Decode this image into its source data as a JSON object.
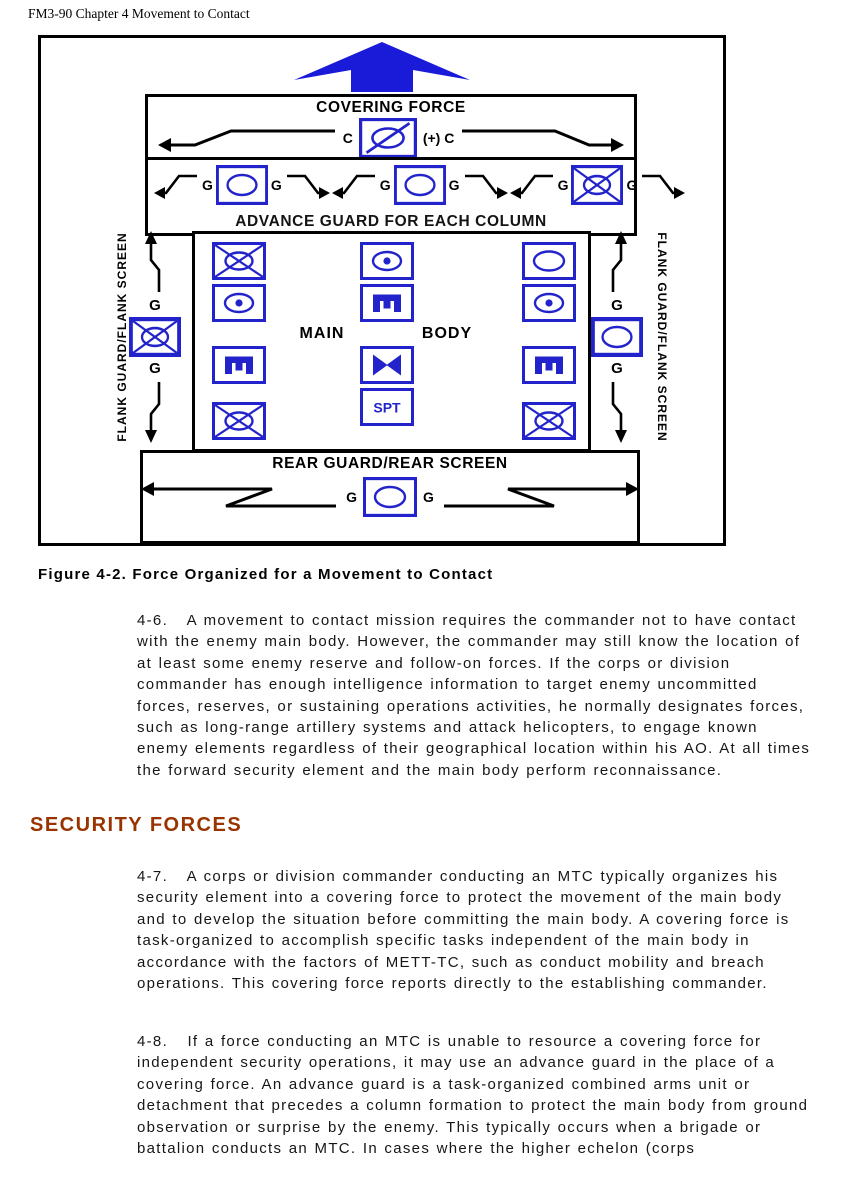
{
  "document": {
    "header": "FM3-90 Chapter 4 Movement to Contact",
    "figure_caption": "Figure 4-2. Force Organized for a Movement to Contact",
    "section_heading": "SECURITY FORCES",
    "paragraphs": [
      {
        "id": "4-6",
        "text": "4-6.   A movement to contact mission requires the commander not to have contact with the enemy main body. However, the commander may still know the location of at least some enemy reserve and follow-on forces. If the corps or division commander has enough intelligence information to target enemy uncommitted forces, reserves, or sustaining operations activities, he normally designates forces, such as long-range artillery systems and attack helicopters, to engage known enemy elements regardless of their geographical location within his AO. At all times the forward security element and the main body perform reconnaissance."
      },
      {
        "id": "4-7",
        "text": "4-7.   A corps or division commander conducting an MTC typically organizes his security element into a covering force to protect the movement of the main body and to develop the situation before committing the main body. A covering force is task-organized to accomplish specific tasks independent of the main body in accordance with the factors of METT-TC, such as conduct mobility and breach operations. This covering force reports directly to the establishing commander."
      },
      {
        "id": "4-8",
        "text": "4-8.   If a force conducting an MTC is unable to resource a covering force for independent security operations, it may use an advance guard in the place of a covering force. An advance guard is a task-organized combined arms unit or detachment that precedes a column formation to protect the main body from ground observation or surprise by the enemy. This typically occurs when a brigade or battalion conducts an MTC. In cases where the higher echelon (corps"
      }
    ]
  },
  "figure": {
    "colors": {
      "symbol_blue": "#2323cc",
      "direction_arrow_blue": "#1a1ad9",
      "heading_brown": "#993300"
    },
    "covering_force": {
      "title": "COVERING FORCE",
      "left_label": "C",
      "right_label": "(+) C",
      "symbol": "cavalry"
    },
    "advance_guard": {
      "title": "ADVANCE GUARD FOR EACH COLUMN",
      "groups": [
        {
          "left": "G",
          "right": "G",
          "symbol": "armor"
        },
        {
          "left": "G",
          "right": "G",
          "symbol": "armor"
        },
        {
          "left": "G",
          "right": "G",
          "symbol": "mech-infantry"
        }
      ]
    },
    "main_body": {
      "label_left": "MAIN",
      "label_right": "BODY",
      "spt_label": "SPT",
      "columns": [
        [
          "mech-infantry",
          "sp-artillery",
          "engineer",
          "mech-infantry"
        ],
        [
          "sp-artillery",
          "engineer",
          "aviation",
          "support"
        ],
        [
          "armor",
          "sp-artillery",
          "engineer",
          "mech-infantry"
        ]
      ]
    },
    "flank_left": {
      "label": "FLANK GUARD/FLANK SCREEN",
      "guard_top": "G",
      "guard_bottom": "G",
      "symbol": "mech-infantry"
    },
    "flank_right": {
      "label": "FLANK GUARD/FLANK SCREEN",
      "guard_top": "G",
      "guard_bottom": "G",
      "symbol": "armor"
    },
    "rear_guard": {
      "title": "REAR GUARD/REAR SCREEN",
      "left_label": "G",
      "right_label": "G",
      "symbol": "armor"
    },
    "symbol_legend": {
      "armor": "oval - armor unit",
      "cavalry": "oval with slash - cavalry/reconnaissance unit",
      "mech-infantry": "crossed X over oval - mechanized infantry unit",
      "sp-artillery": "oval with dot - self-propelled artillery unit",
      "engineer": "rotated E glyph - engineer unit",
      "aviation": "solid bowtie - aviation unit",
      "support": "SPT - support unit"
    }
  }
}
